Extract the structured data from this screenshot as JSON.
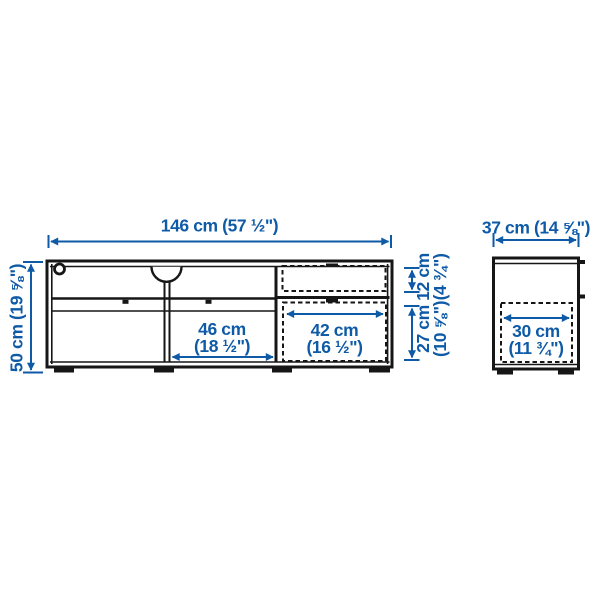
{
  "colors": {
    "accent": "#0e5aa7",
    "line": "#161616",
    "background": "#ffffff"
  },
  "diagram": {
    "product_type": "tv-bench-dimension-drawing",
    "front_view": {
      "total_width": "146 cm (57 ½\")",
      "total_height": "50 cm (19 ⅝\")",
      "shelf_width": {
        "cm": "46 cm",
        "inches": "(18 ½\")"
      },
      "drawer_width": {
        "cm": "42 cm",
        "inches": "(16 ½\")"
      },
      "top_drawer_height": {
        "cm": "12 cm",
        "inches": "(4 ¾\")"
      },
      "bottom_drawer_height": {
        "cm": "27 cm",
        "inches": "(10 ⅝\")"
      }
    },
    "side_view": {
      "total_depth": "37 cm (14 ⅝\")",
      "interior_depth": {
        "cm": "30 cm",
        "inches": "(11 ¾\")"
      }
    }
  }
}
